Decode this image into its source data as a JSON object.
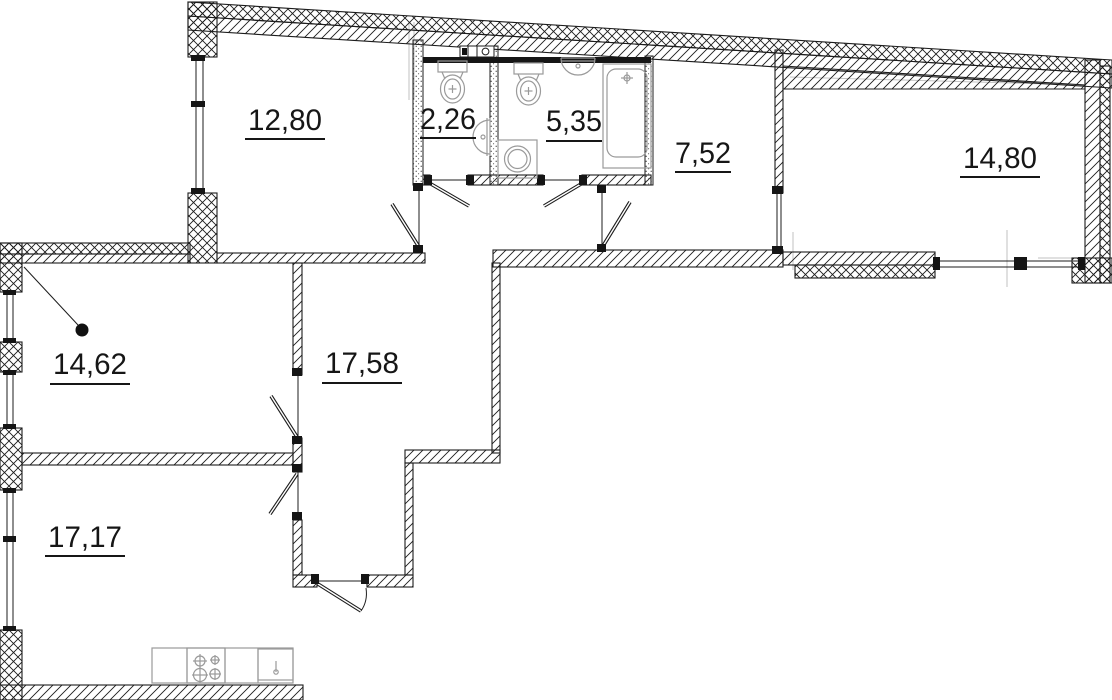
{
  "plan": {
    "background": "#ffffff",
    "line_color": "#1c1c1c",
    "wall_dark_color": "#161616",
    "fixture_color": "#9a9a9a",
    "axis_color": "#c2c2c2",
    "rooms": [
      {
        "id": "room-12-80",
        "area": "12,80"
      },
      {
        "id": "wc-2-26",
        "area": "2,26"
      },
      {
        "id": "bathroom-5-35",
        "area": "5,35"
      },
      {
        "id": "hall-7-52",
        "area": "7,52"
      },
      {
        "id": "room-14-80",
        "area": "14,80"
      },
      {
        "id": "room-14-62",
        "area": "14,62"
      },
      {
        "id": "hallway-17-58",
        "area": "17,58"
      },
      {
        "id": "kitchen-17-17",
        "area": "17,17"
      }
    ],
    "fixtures": [
      "toilet",
      "washbasin",
      "bathtub",
      "washing-machine",
      "stove",
      "kitchen-sink"
    ]
  }
}
